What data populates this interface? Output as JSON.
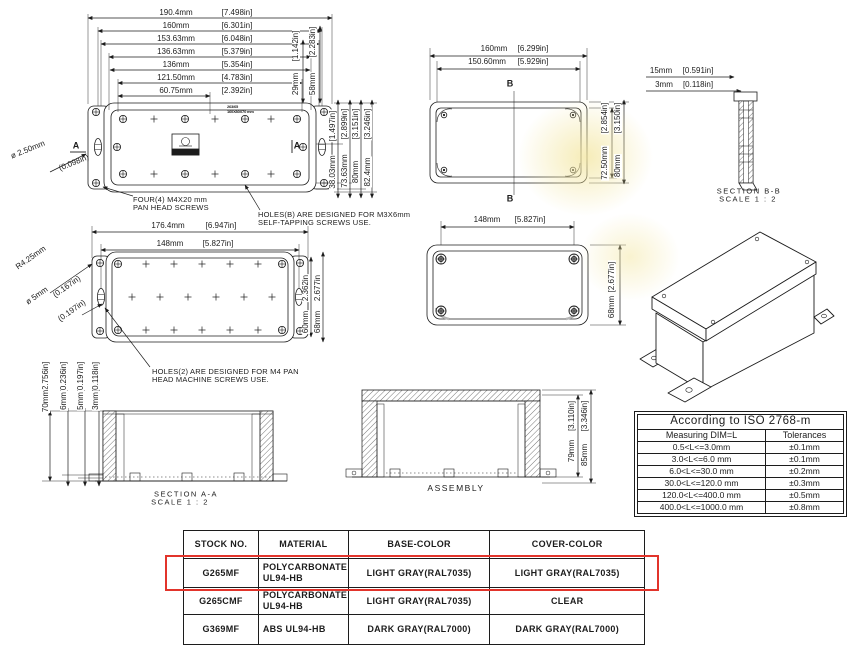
{
  "colors": {
    "ink": "#1c1c1c",
    "highlight": "#e2342b",
    "watermark": "#f3e6a0"
  },
  "front_view": {
    "h_dims": [
      {
        "mm": "190.4mm",
        "in": "[7.498in]"
      },
      {
        "mm": "160mm",
        "in": "[6.301in]"
      },
      {
        "mm": "153.63mm",
        "in": "[6.048in]"
      },
      {
        "mm": "136.63mm",
        "in": "[5.379in]"
      },
      {
        "mm": "136mm",
        "in": "[5.354in]"
      },
      {
        "mm": "121.50mm",
        "in": "[4.783in]"
      },
      {
        "mm": "60.75mm",
        "in": "[2.392in]"
      }
    ],
    "depth_dims": [
      {
        "mm": "29mm",
        "in": "[1.142in]"
      },
      {
        "mm": "58mm",
        "in": "[2.283in]"
      }
    ],
    "height_dims": [
      {
        "mm": "38.03mm",
        "in": "[1.497in]"
      },
      {
        "mm": "73.63mm",
        "in": "[2.899in]"
      },
      {
        "mm": "80mm",
        "in": "[3.151in]"
      },
      {
        "mm": "82.4mm",
        "in": "[3.246in]"
      }
    ],
    "hole_dia_mm": "ø 2.50mm",
    "hole_dia_in": "(0.098in)",
    "section_marker": "A",
    "marking_line1": "263/65",
    "marking_line2": "160X80X70 mm",
    "note_screws_line1": "FOUR(4) M4X20 mm",
    "note_screws_line2": "PAN HEAD SCREWS",
    "note_holes_line1": "HOLES(B) ARE DESIGNED FOR M3X6mm",
    "note_holes_line2": "SELF-TAPPING SCREWS USE."
  },
  "top_view": {
    "h_dims": [
      {
        "mm": "160mm",
        "in": "[6.299in]"
      },
      {
        "mm": "150.60mm",
        "in": "[5.929in]"
      }
    ],
    "v_dims": [
      {
        "mm": "72.50mm",
        "in": "[2.854in]"
      },
      {
        "mm": "80mm",
        "in": "[3.150in]"
      }
    ],
    "section_marker": "B"
  },
  "section_bb": {
    "dims": [
      {
        "mm": "15mm",
        "in": "[0.591in]"
      },
      {
        "mm": "3mm",
        "in": "[0.118in]"
      }
    ],
    "label": "SECTION  B-B",
    "scale": "SCALE  1 : 2"
  },
  "base_view": {
    "h_dims": [
      {
        "mm": "176.4mm",
        "in": "[6.947in]"
      },
      {
        "mm": "148mm",
        "in": "[5.827in]"
      }
    ],
    "v_dims": [
      {
        "mm": "60mm",
        "in": "2.362in"
      },
      {
        "mm": "68mm",
        "in": "2.677in"
      }
    ],
    "radius_mm": "R4.25mm",
    "radius_in": "(0.167in)",
    "dia_mm": "ø 5mm",
    "dia_in": "(0.197in)",
    "note_line1": "HOLES(2) ARE DESIGNED FOR M4 PAN",
    "note_line2": "HEAD MACHINE SCREWS USE."
  },
  "lid_view": {
    "h_dim": {
      "mm": "148mm",
      "in": "[5.827in]"
    },
    "v_dim": {
      "mm": "68mm",
      "in": "[2.677in]"
    }
  },
  "section_aa": {
    "dims": [
      {
        "mm": "70mm",
        "in": "[2.756in]"
      },
      {
        "mm": "6mm",
        "in": "[0.236in]"
      },
      {
        "mm": "5mm",
        "in": "[0.197in]"
      },
      {
        "mm": "3mm",
        "in": "[0.118in]"
      }
    ],
    "label": "SECTION  A-A",
    "scale": "SCALE 1 : 2"
  },
  "assembly": {
    "label": "ASSEMBLY",
    "v_dims": [
      {
        "mm": "79mm",
        "in": "[3.110in]"
      },
      {
        "mm": "85mm",
        "in": "[3.346in]"
      }
    ]
  },
  "tolerance_table": {
    "title": "According to ISO 2768-m",
    "col_headers": [
      "Measuring  DIM=L",
      "Tolerances"
    ],
    "rows": [
      [
        "0.5<L<=3.0mm",
        "±0.1mm"
      ],
      [
        "3.0<L<=6.0 mm",
        "±0.1mm"
      ],
      [
        "6.0<L<=30.0 mm",
        "±0.2mm"
      ],
      [
        "30.0<L<=120.0 mm",
        "±0.3mm"
      ],
      [
        "120.0<L<=400.0 mm",
        "±0.5mm"
      ],
      [
        "400.0<L<=1000.0 mm",
        "±0.8mm"
      ]
    ]
  },
  "stock_table": {
    "headers": [
      "STOCK NO.",
      "MATERIAL",
      "BASE-COLOR",
      "COVER-COLOR"
    ],
    "rows": [
      {
        "stock": "G265MF",
        "material_line1": "POLYCARBONATE",
        "material_line2": "UL94-HB",
        "base": "LIGHT GRAY(RAL7035)",
        "cover": "LIGHT GRAY(RAL7035)",
        "highlighted": true
      },
      {
        "stock": "G265CMF",
        "material_line1": "POLYCARBONATE",
        "material_line2": "UL94-HB",
        "base": "LIGHT GRAY(RAL7035)",
        "cover": "CLEAR",
        "highlighted": false
      },
      {
        "stock": "G369MF",
        "material_line1": "ABS UL94-HB",
        "material_line2": "",
        "base": "DARK GRAY(RAL7000)",
        "cover": "DARK GRAY(RAL7000)",
        "highlighted": false
      }
    ]
  }
}
